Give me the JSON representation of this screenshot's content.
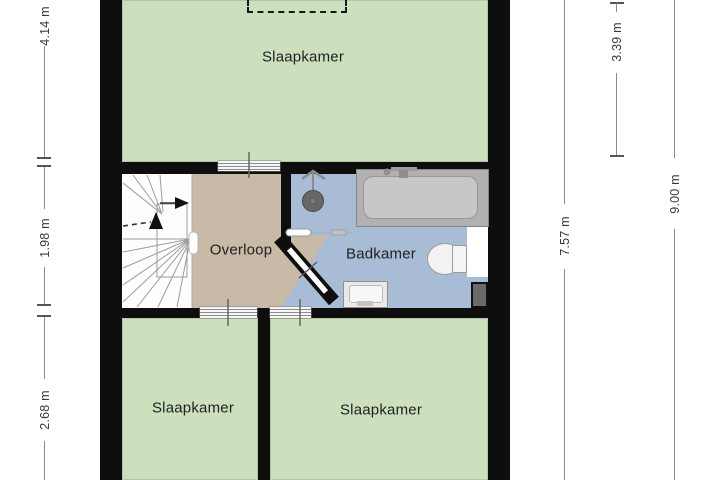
{
  "plan": {
    "name": "floor-plan",
    "rooms": [
      {
        "key": "bedroom_top",
        "label": "Slaapkamer"
      },
      {
        "key": "landing",
        "label": "Overloop"
      },
      {
        "key": "bathroom",
        "label": "Badkamer"
      },
      {
        "key": "bedroom_left",
        "label": "Slaapkamer"
      },
      {
        "key": "bedroom_right",
        "label": "Slaapkamer"
      }
    ],
    "fixtures": [
      "stairs",
      "bathtub",
      "shower",
      "toilet",
      "sink",
      "dormer-outline"
    ]
  },
  "dimensions": {
    "left": [
      {
        "label": "4.14 m"
      },
      {
        "label": "1.98 m"
      },
      {
        "label": "2.68 m"
      }
    ],
    "right": [
      {
        "label": "7.57 m"
      },
      {
        "label": "3.39 m"
      },
      {
        "label": "9.00 m"
      }
    ]
  },
  "colors": {
    "room_floor": "#cde0bd",
    "landing_floor": "#c8baa6",
    "bathroom_floor": "#a9bcd6",
    "wall": "#0e0e0e",
    "dim_line": "#8a8a8a",
    "dim_text": "#3a3a3a"
  }
}
